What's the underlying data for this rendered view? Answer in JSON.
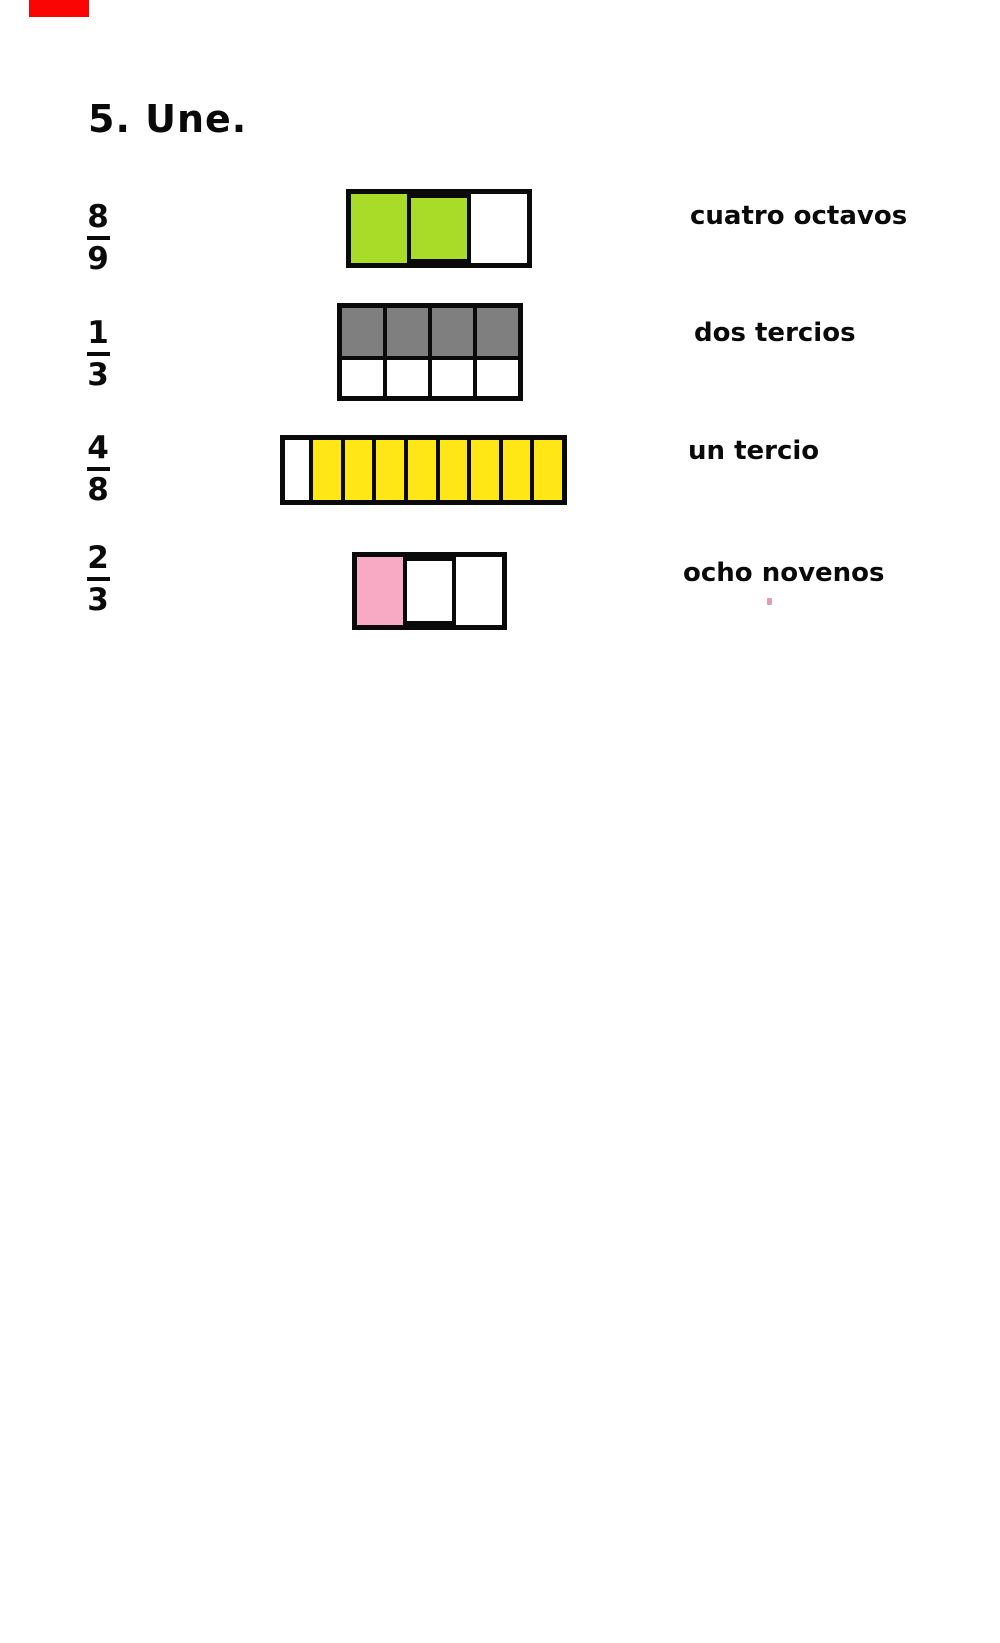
{
  "page": {
    "background": "#ffffff",
    "marker_color": "#fb0404",
    "stray_mark_color": "#dd9eb6"
  },
  "title": "5. Une.",
  "exercise": {
    "fractions": [
      {
        "numerator": "8",
        "denominator": "9"
      },
      {
        "numerator": "1",
        "denominator": "3"
      },
      {
        "numerator": "4",
        "denominator": "8"
      },
      {
        "numerator": "2",
        "denominator": "3"
      }
    ],
    "bars": [
      {
        "name": "two-thirds-green",
        "shaded": 2,
        "total": 3,
        "fill_color": "#a9dc28",
        "rows": [
          [
            "#a9dc28",
            "#a9dc28",
            "#ffffff"
          ]
        ]
      },
      {
        "name": "four-eighths-gray",
        "shaded": 4,
        "total": 8,
        "fill_color": "#7f7f7f",
        "rows": [
          [
            "#7f7f7f",
            "#7f7f7f",
            "#7f7f7f",
            "#7f7f7f"
          ],
          [
            "#ffffff",
            "#ffffff",
            "#ffffff",
            "#ffffff"
          ]
        ]
      },
      {
        "name": "eight-ninths-yellow",
        "shaded": 8,
        "total": 9,
        "fill_color": "#ffe716",
        "rows": [
          [
            "#ffffff",
            "#ffe716",
            "#ffe716",
            "#ffe716",
            "#ffe716",
            "#ffe716",
            "#ffe716",
            "#ffe716",
            "#ffe716"
          ]
        ]
      },
      {
        "name": "one-third-pink",
        "shaded": 1,
        "total": 3,
        "fill_color": "#f8a9c4",
        "rows": [
          [
            "#f8a9c4",
            "#ffffff",
            "#ffffff"
          ]
        ]
      }
    ],
    "labels": [
      "cuatro octavos",
      "dos tercios",
      "un tercio",
      "ocho novenos"
    ]
  }
}
